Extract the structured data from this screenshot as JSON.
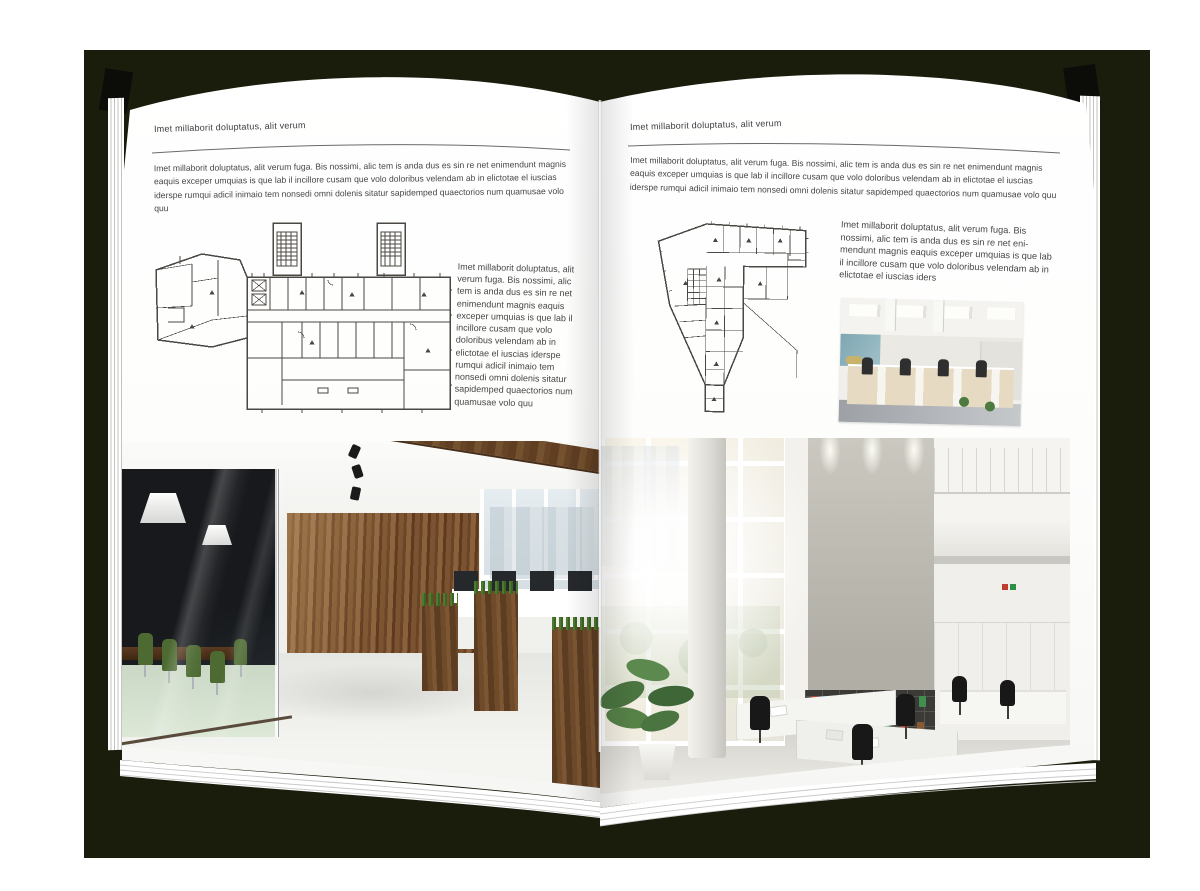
{
  "book": {
    "page_left": {
      "header": "Imet millaborit doluptatus, alit verum",
      "intro": "Imet millaborit doluptatus, alit verum fuga. Bis nossimi, alic tem is anda dus es sin re net enimendunt magnis eaquis exceper umquias is que lab il incillore cusam que volo doloribus velendam ab in elictotae el iuscias iderspe rumqui adicil inimaio tem nonsedi omni dolenis sitatur sapidemped quaectorios num quamusae volo quu",
      "caption": "Imet millaborit doluptatus, alit verum fuga. Bis nossimi, alic tem is anda dus es sin re net enimendunt magnis eaquis exceper umquias is que lab il incillore cusam que volo doloribus velendam ab in elictotae el iuscias iderspe rumqui adicil inimaio tem nonsedi omni dolenis sitatur sapidemped quaectorios num quamusae volo quu"
    },
    "page_right": {
      "header": "Imet millaborit doluptatus, alit verum",
      "intro": "Imet millaborit doluptatus, alit verum fuga. Bis nossimi, alic tem is anda dus es sin re net enimendunt magnis eaquis exceper umquias is que lab il incillore cusam que volo doloribus velendam ab in elictotae el iuscias iderspe rumqui adicil inimaio tem nonsedi omni dolenis sitatur sapidemped quaectorios num quamusae volo quu",
      "caption": "Imet millaborit doluptatus, alit verum fuga. Bis nossimi, alic tem is anda dus es sin re net eni-mendunt magnis eaquis exceper umquias is que lab il incillore cusam que volo doloribus velendam ab in elictotae el iuscias iders"
    }
  },
  "colors": {
    "backdrop": "#1a1c0c",
    "page": "#ffffff",
    "body_text": "#464646",
    "header_rule": "#6a6a6a",
    "plan_line": "#4b4843",
    "wood": "#6f4b2a",
    "meeting_room_glass": "#17191c",
    "chair_green": "#4c6a31",
    "meeting_floor_mint": "#cbd8c6",
    "concrete": "#b1aea6",
    "binder_red": "#b5412f",
    "binder_green": "#3f8f4f",
    "binder_blue": "#3a6fae",
    "binder_tan": "#8a5a33"
  }
}
